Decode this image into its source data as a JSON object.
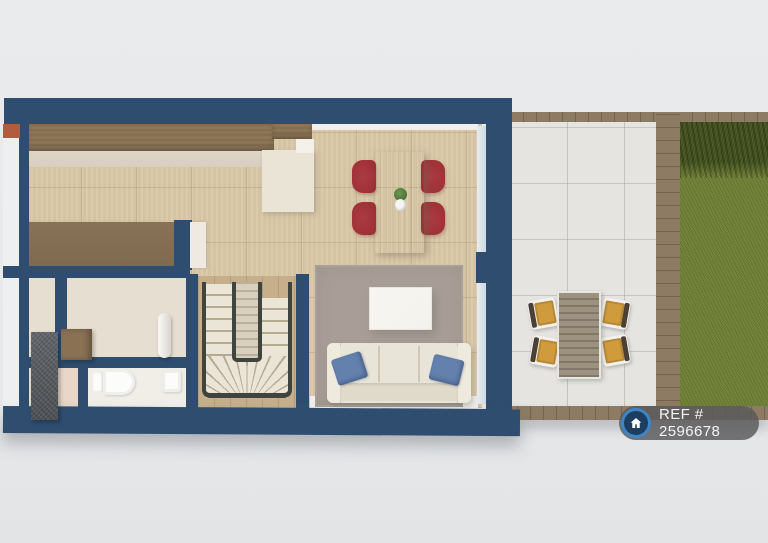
{
  "badge": {
    "icon": "house-icon",
    "ref_label": "REF # 2596678"
  },
  "palette": {
    "background": "#e9ebec",
    "wall": "#2f4d6e",
    "wall_face": "#edeff0",
    "terracotta": "#b25c3f",
    "tile_floor": "#d9c8a7",
    "hall_floor": "#e6ded0",
    "wc_floor": "#f1eee8",
    "niche_floor": "#e8d7c8",
    "wood_counter": "#8d7657",
    "counter_edge": "#d8cfc0",
    "island_wood": "#7e6a4f",
    "peninsula": "#eae4d6",
    "dining_table": "#9c8c74",
    "chair_red": "#9e3036",
    "rug": "#a89e97",
    "sofa": "#e9e4d8",
    "sofa_back": "#e0dacb",
    "pillow_blue": "#6480ad",
    "coffee_table": "#f4f2ed",
    "stair_wood": "#c7af8c",
    "stair_tread": "#ebe5d7",
    "stair_tread_edge": "#b5a98f",
    "stair_rail": "#40443e",
    "stone_grey": "#595d61",
    "cabinet_brown": "#8a7154",
    "fixture_white": "#fcfcfa",
    "patio_tile": "#e5e4e0",
    "wood_border": "#8d7b63",
    "outdoor_table": "#9d9180",
    "outdoor_chair_seat": "#d09b3d",
    "outdoor_chair_back": "#4a4034",
    "grass": "#6e7e34",
    "hedge": "#43511f",
    "glass": "#cdd9e3",
    "badge_bg": "rgba(88,88,90,0.82)",
    "badge_text": "#f4f4f4",
    "badge_icon_bg": "#1d3e5e",
    "badge_icon_ring": "#3c86c8"
  },
  "scene": {
    "type": "3d-floor-plan-top-view",
    "rooms": [
      "kitchen",
      "dining-area",
      "living-room",
      "hallway",
      "wc",
      "staircase",
      "patio",
      "garden"
    ],
    "furniture": [
      "kitchen-counter",
      "kitchen-island",
      "dining-table",
      "dining-chairs-red-x4",
      "vase-with-plant",
      "rug",
      "coffee-table",
      "sofa",
      "blue-cushions-x2",
      "u-shaped-staircase",
      "toilet",
      "wash-basin",
      "stone-storage-column",
      "wooden-cabinet",
      "outdoor-dining-table",
      "outdoor-chairs-x4",
      "hedge",
      "lawn"
    ]
  }
}
